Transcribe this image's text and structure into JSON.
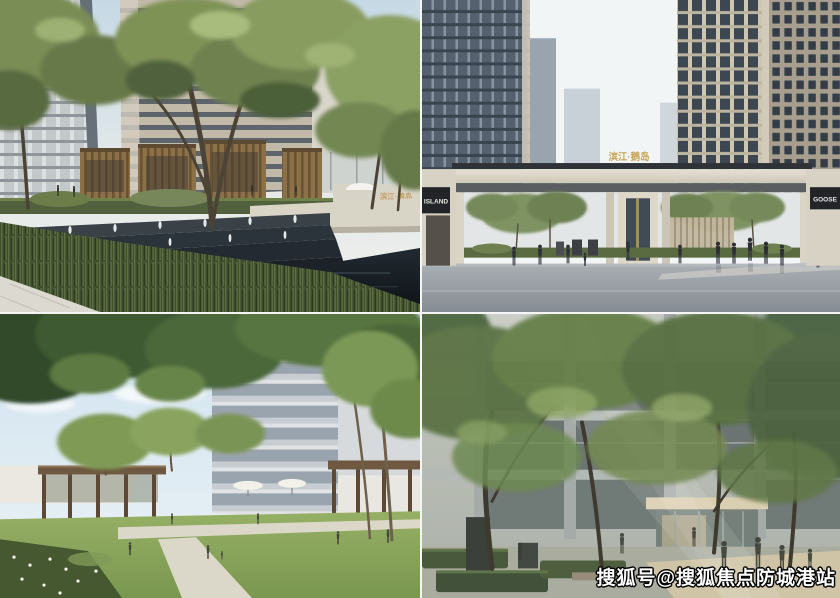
{
  "collage": {
    "panels": [
      {
        "name": "water-feature-plaza"
      },
      {
        "name": "entrance-gate"
      },
      {
        "name": "central-lawn-garden"
      },
      {
        "name": "tree-courtyard"
      }
    ]
  },
  "signs": {
    "plaza_name": "滨江·鹅岛",
    "gate_name": "滨江·鹅岛",
    "left_wall": "ISLAND",
    "right_wall": "GOOSE"
  },
  "watermark": {
    "text": "搜狐号@搜狐焦点防城港站",
    "fill": "#ffffff",
    "outline": "#000000"
  },
  "colors": {
    "sky": "#dce9f1",
    "foliage_dark": "#3c5a33",
    "foliage_mid": "#66804a",
    "foliage_light": "#8ea765",
    "wood_slat": "#8c7148",
    "cascade_stone": "#20262c",
    "road": "#9aa1a7",
    "facade_beige": "#a89e8e",
    "facade_glass": "#55616e",
    "sign_gold": "#c9a557",
    "lawn": "#86a159"
  }
}
